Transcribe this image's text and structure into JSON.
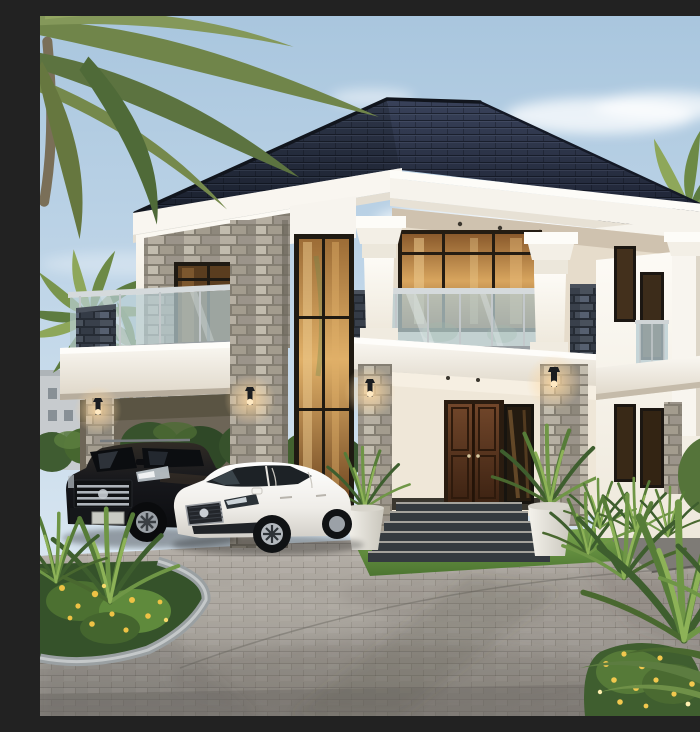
{
  "scene": {
    "type": "photorealistic 3D architectural exterior rendering",
    "description": "Luxury two-storey tropical villa at dusk: white stucco facade with grey stacked-stone piers, charcoal hip roof, central loggia with glass balustrade between two white classical columns, double-height glazed bay with warm curtained light, dark hardwood double entry door up stone steps flanked by white planter urns, lit wall sconces, carport on the left sheltering a black SUV with a white sedan parked beside it, paver driveway, tropical landscaping with palm trees, clipped hedges, spiky accent plants and yellow flowers under a soft blue sky.",
    "time_of_day": "late afternoon / dusk with warm accent lighting",
    "sky": "clear light-blue sky with soft white clouds"
  },
  "house": {
    "style": "modern two-storey villa",
    "walls": "white stucco with grey stacked-stone veneer piers",
    "roof": "charcoal tiled hip roof with deep white moulded cornices",
    "features": [
      "central first-floor loggia with frameless glass balustrade",
      "two white columns with moulded capitals",
      "double-height glazed window bay with warm curtain glow",
      "dark hardwood double entry door with glass sidelight",
      "stone entry steps with light nosings",
      "white planter urns with palms",
      "carport with stone pillar",
      "glass juliet balcony on right wing",
      "four lit bronze wall sconces"
    ]
  },
  "vehicles": [
    {
      "kind": "SUV",
      "color": "black",
      "position": "under carport, left",
      "details": "chrome bar grille, roof rails, alloy wheels"
    },
    {
      "kind": "sedan",
      "color": "white",
      "position": "parked in front, centre-left",
      "details": "dark mesh grille, sleek headlights, five-spoke alloys"
    }
  ],
  "landscaping": [
    "overhanging coconut palm fronds, top-left",
    "palm cluster behind left wing",
    "palm cluster behind right wing",
    "clipped hedge row behind carport",
    "curved curbed garden bed with yellow flowers, bottom-left",
    "dense spiky tropical plants and yellow flower shrub, bottom-right",
    "bright lawn strip at entry",
    "grey paver driveway with dark stone walkway"
  ],
  "background": "low-rise grey apartment buildings at far left",
  "lighting": [
    "warm amber glow in upstairs and downstairs windows",
    "four wall sconces glowing warm",
    "soft tree shadows across the driveway"
  ],
  "palette": {
    "sky-top": "#a9c6de",
    "sky-horizon": "#e7eff5",
    "roof": "#212838",
    "wall-white": "#f8f5ef",
    "stone-grey": "#a59e92",
    "stone-dark": "#343a44",
    "glass-railing": "#b7cdd3",
    "window-warm": "#d8a55e",
    "door-wood": "#5a3420",
    "driveway": "#a8a39c",
    "lawn": "#679441",
    "foliage": "#567c38",
    "flower-yellow": "#f0c44e",
    "suv-black": "#121417",
    "sedan-white": "#f2f1ee"
  }
}
